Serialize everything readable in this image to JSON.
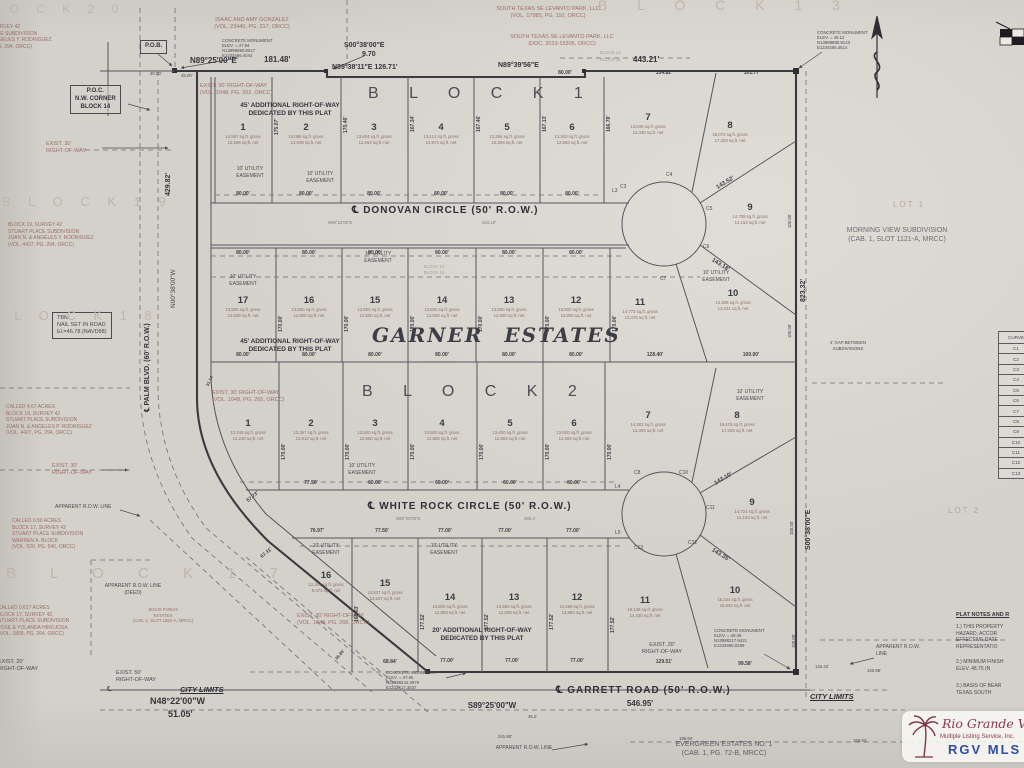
{
  "palette": {
    "paper": "#d4d1ca",
    "ink": "#4a4a50",
    "heavy": "#3a3a41",
    "deed_red": "#9a6f65",
    "ghost": "#bfb5aa",
    "wm_maroon": "#8b3a44",
    "wm_blue": "#2d4f9e"
  },
  "top": {
    "ghost_block20": "L O C K   2 0",
    "ghost_block13": "B L O C K   1 3",
    "owner_left": "ISAAC AND AMY GONZALEZ\n(VOL. 23440, PG. 217, ORCC)",
    "owner_r1": "SOUTH TEXAS SE LEVANTO PARK, LLC\n(VOL. 17985, PG. 110, ORCC)",
    "owner_r2": "SOUTH TEXAS SE LEVANTO PARK, LLC\n(DOC. 2023-15305, ORCC)",
    "mon_nw": "CONCRETE MONUMENT\nELEV. = 47.94\nN13989880.8017\nE1233466.4044",
    "mon_ne": "CONCRETE MONUMENT\nELEV. = 48.12\nN13989880.8143\nE1234466.4514",
    "pob": "P.O.B.",
    "brg1": "N89°25'00\"E",
    "len1": "181.48'",
    "brg2": "S00°38'00\"E",
    "len2": "9.70",
    "brg3": "N89°38'11\"E  126.71'",
    "brg4": "N89°39'56\"E",
    "len3": "443.21'",
    "sub1": "80.00'",
    "sub2": "134.82'",
    "sub3": "101.77'",
    "j1": "30.00'",
    "j2": "45.00'",
    "blk13": "BLOCK 13",
    "blk14": "BLOCK 14"
  },
  "left": {
    "deed20": "BLOCK 20, SURVEY 42\nSTUART PLACE SUBDIVISION\nJUAN N. & ANGELES Y. RODRIGUEZ\n(VOL. 4427, PG. 294, ORCC)",
    "poc": "P.O.C.\nN.W. CORNER\nBLOCK 14",
    "row30a": "EXIST. 30'\nRIGHT-OF-WAY",
    "ghost19": "B L O C K   1 9",
    "deed19": "BLOCK 19, SURVEY 42\nSTUART PLACE SUBDIVISION\nJUAN N. & ANGELES Y. RODRIGUEZ\n(VOL. 4427, PG. 294, ORCC)",
    "dim_429": "429.82'",
    "brg_palm": "N00°38'00\"W",
    "palm_label": "℄ PALM BLVD. (60' R.O.W.)",
    "tbm": "TBM:\nNAIL SET IN ROAD\nEl.=46.78 (NAVD88)",
    "ghost18": "B L O C K   1 8",
    "deed18": "CALLED 4.67 ACRES\nBLOCK 18, SURVEY 42\nSTUART PLACE SUBDIVISION\nJUAN N. & ANGELES P. RODRIGUEZ\n(VOL. 4427, PG. 294, ORCC)",
    "row30b": "EXIST. 30'\nRIGHT-OF-WAY",
    "app_row": "APPARENT R.O.W. LINE",
    "deed17a": "CALLED 0.50 ACRES\nBLOCK 17, SURVEY 42\nSTUART PLACE SUBDIVISION\nWARREN A. BLOCK\n(VOL. 520, PG. 540, ORCC)",
    "ghost17": "B L O C K   1 7",
    "app_row_deed": "APPARENT R.O.W. LINE\n(DEED)",
    "deed17b": "CALLED 0.617 ACRES\nBLOCK 17, SURVEY 42,\nSTUART PLACE SUBDIVISION\nJOSE & YOLANDA HINOJOSA\n(VOL. 1868, PG. 264, ORCC)",
    "farias": "JESUS FARIAS\nESTATES\n(CAB. 1, SLOT 1684-A, MRCC)",
    "row20": "EXIST. 20'\nRIGHT-OF-WAY",
    "row50": "EXIST. 50'\nRIGHT-OF-WAY",
    "city_limits": "CITY LIMITS",
    "cl_sym": "℄",
    "brg_n48": "N48°22'00\"W",
    "len_n48": "51.05'"
  },
  "right": {
    "lot1": "LOT 1",
    "morning": "MORNING VIEW SUBDIVISION\n(CAB. 1, SLOT 1121-A, MRCC)",
    "dim_823": "823.32'",
    "brg_s00": "S00°38'00\"E",
    "lot2": "LOT 2",
    "gap": "4' GAP BETWEEN\nSUBDIVISIONS",
    "d100": "100.00'",
    "city_limits": "CITY LIMITS",
    "app_row": "APPARENT R.O.W.\nLINE"
  },
  "bottom": {
    "brg_s89": "S89°25'00\"W",
    "len_546": "546.95'",
    "d45": "45.2'",
    "d241": "241.90'",
    "d196": "196.94'",
    "d132": "132.42'",
    "d130": "130.98'",
    "d156": "156.94'",
    "evergreen": "EVERGREEN ESTATES NO. 1\n(CAB. 1, PG. 72-B, MRCC)",
    "app_row": "APPARENT R.O.W. LINE",
    "mon_sw": "CONCRETE MONUMENT\nELEV. = 47.96\nN13988242.3979\nE1232417.3037",
    "mon_se": "CONCRETE MONUMENT\nELEV. = 48.46\nN13988217.9421\nE1233465.0269",
    "row20": "EXIST. 20'\nRIGHT-OF-WAY"
  },
  "streets": {
    "donovan": "℄ DONOVAN CIRCLE (50' R.O.W.)",
    "whiterock": "℄ WHITE ROCK CIRCLE (50' R.O.W.)",
    "garrett": "℄ GARRETT ROAD (50' R.O.W.)",
    "don_brg": "N89°22'00\"E",
    "don_len": "543.18'",
    "wr_brg": "N89°22'00\"E",
    "wr_len": "450.4'"
  },
  "blocks": {
    "b1": "B L O C K   1",
    "b2": "B L O C K   2",
    "estates": "GARNER  ESTATES",
    "ghost_b14_15": "BLOCK 14\nBLOCK 15"
  },
  "notes": {
    "add45": "45' ADDITIONAL RIGHT-OF-WAY\nDEDICATED BY THIS PLAT",
    "add20": "20' ADDITIONAL RIGHT-OF-WAY\nDEDICATED BY THIS PLAT",
    "exist30_202": "EXIST. 30' RIGHT-OF-WAY\n(VOL. 1048, PG. 202, ORCC)",
    "exist30_265": "EXIST. 30' RIGHT-OF-WAY\n(VOL. 1048, PG. 265, ORCC)",
    "exist30_268": "EXIST. 30' RIGHT-OF-WAY\n(VOL. 1048, PG. 268, ORCC)",
    "esmt": "10' UTILITY\nEASEMENT"
  },
  "plat_notes": {
    "title": "PLAT NOTES AND R",
    "n1": "1.)  THIS PROPERTY\n      HAZARD, ACCOR\n      EFFECTIVE DATE\n      REPRESENTATIO",
    "n2": "2.)  MINIMUM FINISH\n      ELEV. 48.75 (N",
    "n3": "3.)  BASIS OF BEAR\n      TEXAS SOUTH"
  },
  "curve_table": {
    "header": "CURVE",
    "rows": [
      "C1",
      "C2",
      "C3",
      "C4",
      "C5",
      "C6",
      "C7",
      "C8",
      "C9",
      "C10",
      "C11",
      "C12",
      "C13"
    ]
  },
  "lots": {
    "b1r1": [
      {
        "n": "1",
        "a": "14,597 sq.ft. gross\n13,586 sq.ft. net"
      },
      {
        "n": "2",
        "a": "14,086 sq.ft. gross\n13,048 sq.ft. net"
      },
      {
        "n": "3",
        "a": "13,604 sq.ft. gross\n12,664 sq.ft. net"
      },
      {
        "n": "4",
        "a": "13,414 sq.ft. gross\n12,874 sq.ft. net"
      },
      {
        "n": "5",
        "a": "13,384 sq.ft. gross\n12,594 sq.ft. net"
      },
      {
        "n": "6",
        "a": "13,363 sq.ft. gross\n12,593 sq.ft. net"
      }
    ],
    "b1l7": {
      "n": "7",
      "a": "13,848 sq.ft. gross\n13,330 sq.ft. net"
    },
    "b1l8": {
      "n": "8",
      "a": "18,072 sq.ft. gross\n17,320 sq.ft. net"
    },
    "b1l9": {
      "n": "9",
      "a": "14,708 sq.ft. gross\n14,154 sq.ft. net"
    },
    "b1l10": {
      "n": "10",
      "a": "13,485 sq.ft. gross\n13,031 sq.ft. net"
    },
    "b1r2": [
      {
        "n": "17",
        "a": "13,600 sq.ft. gross\n12,536 sq.ft. net"
      },
      {
        "n": "16",
        "a": "13,600 sq.ft. gross\n12,600 sq.ft. net"
      },
      {
        "n": "15",
        "a": "13,500 sq.ft. gross\n12,500 sq.ft. net"
      },
      {
        "n": "14",
        "a": "13,500 sq.ft. gross\n12,500 sq.ft. net"
      },
      {
        "n": "13",
        "a": "13,600 sq.ft. gross\n12,650 sq.ft. net"
      },
      {
        "n": "12",
        "a": "13,600 sq.ft. gross\n12,800 sq.ft. net"
      },
      {
        "n": "11",
        "a": "14,772 sq.ft. gross\n13,479 sq.ft. net"
      }
    ],
    "b2r1": [
      {
        "n": "1",
        "a": "13,349 sq.ft. gross\n12,240 sq.ft. net"
      },
      {
        "n": "2",
        "a": "13,367 sq.ft. gross\n12,812 sq.ft. net"
      },
      {
        "n": "3",
        "a": "13,500 sq.ft. gross\n12,550 sq.ft. net"
      },
      {
        "n": "4",
        "a": "13,500 sq.ft. gross\n12,806 sq.ft. net"
      },
      {
        "n": "5",
        "a": "13,400 sq.ft. gross\n12,506 sq.ft. net"
      },
      {
        "n": "6",
        "a": "13,600 sq.ft. gross\n12,606 sq.ft. net"
      },
      {
        "n": "7",
        "a": "14,282 sq.ft. gross\n13,394 sq.ft. net"
      }
    ],
    "b2l8": {
      "n": "8",
      "a": "18,478 sq.ft. gross\n17,228 sq.ft. net"
    },
    "b2l9": {
      "n": "9",
      "a": "14,724 sq.ft. gross\n14,153 sq.ft. net"
    },
    "b2l10": {
      "n": "10",
      "a": "16,224 sq.ft. gross\n15,634 sq.ft. net"
    },
    "b2r3": [
      {
        "n": "16",
        "a": "12,361 sq.ft. gross\n9,373 sq.ft. net"
      },
      {
        "n": "15",
        "a": "13,837 sq.ft. gross\n12,637 sq.ft. net"
      },
      {
        "n": "14",
        "a": "13,805 sq.ft. gross\n12,859 sq.ft. net"
      },
      {
        "n": "13",
        "a": "13,583 sq.ft. gross\n12,839 sq.ft. net"
      },
      {
        "n": "12",
        "a": "13,468 sq.ft. gross\n12,884 sq.ft. net"
      },
      {
        "n": "11",
        "a": "18,135 sq.ft. gross\n14,430 sq.ft. net"
      }
    ]
  },
  "dims": {
    "d80": "80.00'",
    "d77": "77.00'",
    "d7750": "77.50'",
    "d60": "60.00'",
    "d7697": "76.97'",
    "d6711": "67.11'",
    "d5773": "57.73'",
    "d6884": "68.84'",
    "d12951": "129.51'",
    "d9958": "99.58'",
    "d12840": "128.40'",
    "d100": "100.00'",
    "L3": "L3",
    "L4": "L4",
    "L5": "L5",
    "v1": "175.07'",
    "v2": "170.46'",
    "v3": "167.34'",
    "v4": "167.46'",
    "v5": "167.13'",
    "v6": "166.78'",
    "v170": "170.00'",
    "v16863": "168.63'",
    "v17752": "177.52'",
    "v3114": "31.14'",
    "v3695": "36.95'",
    "diag1": "143.52'",
    "diag2": "143.18'",
    "diag3": "143.10'",
    "diag4": "143.35'",
    "c3": "C3",
    "c4": "C4",
    "c5": "C5",
    "c6": "C6",
    "c7": "C7",
    "c8": "C8",
    "c10": "C10",
    "c11": "C11",
    "c12": "C12",
    "c13": "C13"
  },
  "watermark": {
    "script": "Rio Grande Valley",
    "sub": "Multiple Listing Service, Inc.",
    "brand": "RGV MLS"
  }
}
